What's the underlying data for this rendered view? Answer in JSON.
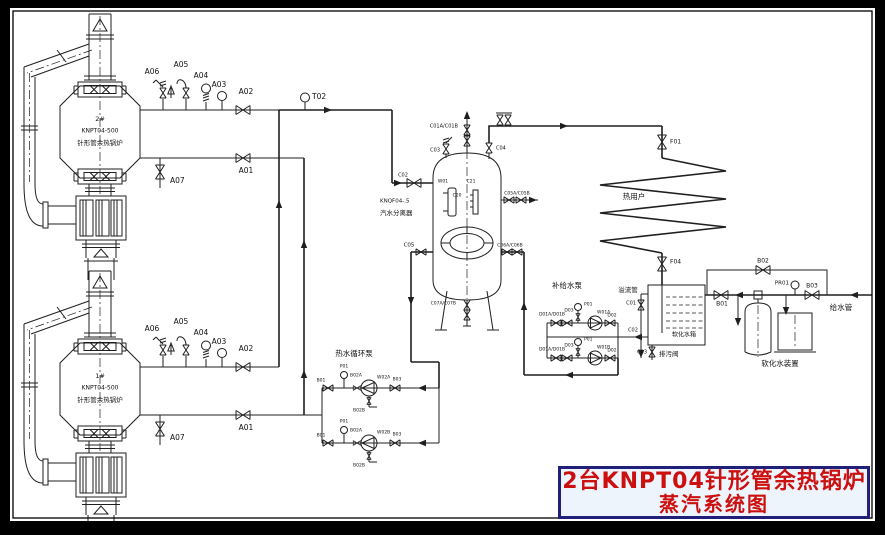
{
  "colors": {
    "line": "#1f1f1f",
    "background": "#ffffff",
    "frame": "#000000",
    "title_text": "#cc0f0f",
    "title_border": "#20207a",
    "title_bg": "#eef4fb"
  },
  "title_block": {
    "line1": "2台KNPT04针形管余热锅炉",
    "line2": "蒸汽系统图"
  },
  "labels": [
    {
      "n": "tag-a06-b1",
      "t": "A06",
      "x": 152,
      "y": 72,
      "s": 7.5
    },
    {
      "n": "tag-a05-b1",
      "t": "A05",
      "x": 181,
      "y": 65,
      "s": 7.5
    },
    {
      "n": "tag-a04-b1",
      "t": "A04",
      "x": 201,
      "y": 76,
      "s": 7.5
    },
    {
      "n": "tag-a03-b1",
      "t": "A03",
      "x": 219,
      "y": 85,
      "s": 7.5
    },
    {
      "n": "tag-a02-b1",
      "t": "A02",
      "x": 246,
      "y": 92,
      "s": 7.5
    },
    {
      "n": "tag-a01-b1",
      "t": "A01",
      "x": 246,
      "y": 171,
      "s": 7.5
    },
    {
      "n": "tag-a07-b1",
      "t": "A07",
      "x": 170,
      "y": 181,
      "s": 7.5,
      "a": "s"
    },
    {
      "n": "boi​ler1-number",
      "t": "2#",
      "x": 100,
      "y": 119,
      "s": 6.5
    },
    {
      "n": "boiler1-model",
      "t": "KNPT04-500",
      "x": 100,
      "y": 131,
      "s": 6
    },
    {
      "n": "boiler1-name",
      "t": "针形管余热锅炉",
      "x": 100,
      "y": 143,
      "s": 6.5
    },
    {
      "n": "tag-a06-b2",
      "t": "A06",
      "x": 152,
      "y": 329,
      "s": 7.5
    },
    {
      "n": "tag-a05-b2",
      "t": "A05",
      "x": 181,
      "y": 322,
      "s": 7.5
    },
    {
      "n": "tag-a04-b2",
      "t": "A04",
      "x": 201,
      "y": 333,
      "s": 7.5
    },
    {
      "n": "tag-a03-b2",
      "t": "A03",
      "x": 219,
      "y": 342,
      "s": 7.5
    },
    {
      "n": "tag-a02-b2",
      "t": "A02",
      "x": 246,
      "y": 349,
      "s": 7.5
    },
    {
      "n": "tag-a01-b2",
      "t": "A01",
      "x": 246,
      "y": 428,
      "s": 7.5
    },
    {
      "n": "tag-a07-b2",
      "t": "A07",
      "x": 170,
      "y": 438,
      "s": 7.5,
      "a": "s"
    },
    {
      "n": "boiler2-number",
      "t": "1#",
      "x": 100,
      "y": 376,
      "s": 6.5
    },
    {
      "n": "boiler2-model",
      "t": "KNPT04-500",
      "x": 100,
      "y": 388,
      "s": 6
    },
    {
      "n": "boiler2-name",
      "t": "针形管余热锅炉",
      "x": 100,
      "y": 400,
      "s": 6.5
    },
    {
      "n": "tag-t02",
      "t": "T02",
      "x": 312,
      "y": 97,
      "s": 7.5,
      "a": "s"
    },
    {
      "n": "tag-c01ab",
      "t": "C01A/C01B",
      "x": 458,
      "y": 126,
      "s": 5,
      "a": "e"
    },
    {
      "n": "tag-c03-vessel",
      "t": "C03",
      "x": 440,
      "y": 150,
      "s": 5,
      "a": "e"
    },
    {
      "n": "tag-c04",
      "t": "C04",
      "x": 496,
      "y": 148,
      "s": 5,
      "a": "s"
    },
    {
      "n": "tag-c02-vessel",
      "t": "C02",
      "x": 403,
      "y": 175,
      "s": 5
    },
    {
      "n": "tag-w01",
      "t": "W01",
      "x": 443,
      "y": 181,
      "s": 4.5
    },
    {
      "n": "tag-c21",
      "t": "C21",
      "x": 471,
      "y": 181,
      "s": 4.5
    },
    {
      "n": "tag-c20",
      "t": "C20",
      "x": 457,
      "y": 195,
      "s": 4.5
    },
    {
      "n": "separator-model",
      "t": "KNQF04-.5",
      "x": 380,
      "y": 201,
      "s": 5.5,
      "a": "s"
    },
    {
      "n": "separator-name",
      "t": "汽水分离器",
      "x": 380,
      "y": 213,
      "s": 6.5,
      "a": "s"
    },
    {
      "n": "tag-c05ab",
      "t": "C05A/C05B",
      "x": 517,
      "y": 193,
      "s": 4.5
    },
    {
      "n": "tag-c05",
      "t": "C05",
      "x": 409,
      "y": 245,
      "s": 5.5
    },
    {
      "n": "tag-c06ab",
      "t": "C06A/C06B",
      "x": 510,
      "y": 245,
      "s": 4.5
    },
    {
      "n": "tag-c07ab",
      "t": "C07A/C07B",
      "x": 456,
      "y": 303,
      "s": 4.5,
      "a": "e"
    },
    {
      "n": "tag-f01",
      "t": "F01",
      "x": 670,
      "y": 142,
      "s": 6,
      "a": "s"
    },
    {
      "n": "heat-user-label",
      "t": "热用户",
      "x": 634,
      "y": 197,
      "s": 7.5
    },
    {
      "n": "tag-f04",
      "t": "F04",
      "x": 670,
      "y": 262,
      "s": 6,
      "a": "s"
    },
    {
      "n": "overflow-pipe-label",
      "t": "溢流管",
      "x": 628,
      "y": 290,
      "s": 6.5
    },
    {
      "n": "tag-c01-tank",
      "t": "C01",
      "x": 636,
      "y": 303,
      "s": 5,
      "a": "e"
    },
    {
      "n": "tag-c02-tank",
      "t": "C02",
      "x": 633,
      "y": 330,
      "s": 5
    },
    {
      "n": "tag-c03-tank",
      "t": "C03",
      "x": 647,
      "y": 352,
      "s": 5,
      "a": "e"
    },
    {
      "n": "blowdown-valve-label",
      "t": "排污阀",
      "x": 659,
      "y": 354,
      "s": 6.5,
      "a": "s"
    },
    {
      "n": "softened-water-tank-label",
      "t": "软化水箱",
      "x": 684,
      "y": 335,
      "s": 6
    },
    {
      "n": "feedwater-pump-label",
      "t": "补给水泵",
      "x": 567,
      "y": 286,
      "s": 7.5
    },
    {
      "n": "tag-d01ab-top",
      "t": "D01A/D01B",
      "x": 552,
      "y": 314,
      "s": 4.5
    },
    {
      "n": "tag-d03-top",
      "t": "D03",
      "x": 569,
      "y": 310,
      "s": 4.5
    },
    {
      "n": "tag-p01-feed-top",
      "t": "P01",
      "x": 584,
      "y": 304,
      "s": 4.5,
      "a": "s"
    },
    {
      "n": "tag-w01a",
      "t": "W01A",
      "x": 597,
      "y": 312,
      "s": 4.5,
      "a": "s"
    },
    {
      "n": "tag-d02-top",
      "t": "D02",
      "x": 612,
      "y": 315,
      "s": 4.5
    },
    {
      "n": "tag-d01ab-bot",
      "t": "D01A/D01B",
      "x": 552,
      "y": 349,
      "s": 4.5
    },
    {
      "n": "tag-d03-bot",
      "t": "D03",
      "x": 569,
      "y": 345,
      "s": 4.5
    },
    {
      "n": "tag-p01-feed-bot",
      "t": "P01",
      "x": 584,
      "y": 339,
      "s": 4.5,
      "a": "s"
    },
    {
      "n": "tag-w01b",
      "t": "W01B",
      "x": 597,
      "y": 347,
      "s": 4.5,
      "a": "s"
    },
    {
      "n": "tag-d02-bot",
      "t": "D02",
      "x": 612,
      "y": 350,
      "s": 4.5
    },
    {
      "n": "circulation-pump-label",
      "t": "热水循环泵",
      "x": 354,
      "y": 354,
      "s": 7.5
    },
    {
      "n": "tag-b01-circ-top",
      "t": "B01",
      "x": 321,
      "y": 380,
      "s": 4.5
    },
    {
      "n": "tag-p01-circ-top",
      "t": "P01",
      "x": 344,
      "y": 366,
      "s": 4.5
    },
    {
      "n": "tag-b02a-top",
      "t": "B02A",
      "x": 356,
      "y": 375,
      "s": 4.5
    },
    {
      "n": "tag-w02a",
      "t": "W02A",
      "x": 377,
      "y": 377,
      "s": 4.5,
      "a": "s"
    },
    {
      "n": "tag-b03-circ-top",
      "t": "B03",
      "x": 397,
      "y": 379,
      "s": 4.5
    },
    {
      "n": "tag-b02b-top",
      "t": "B02B",
      "x": 359,
      "y": 410,
      "s": 4.5
    },
    {
      "n": "tag-b01-circ-bot",
      "t": "B01",
      "x": 321,
      "y": 435,
      "s": 4.5
    },
    {
      "n": "tag-p01-circ-bot",
      "t": "P01",
      "x": 344,
      "y": 421,
      "s": 4.5
    },
    {
      "n": "tag-b02a-bot",
      "t": "B02A",
      "x": 356,
      "y": 430,
      "s": 4.5
    },
    {
      "n": "tag-w02b",
      "t": "W02B",
      "x": 377,
      "y": 432,
      "s": 4.5,
      "a": "s"
    },
    {
      "n": "tag-b03-circ-bot",
      "t": "B03",
      "x": 397,
      "y": 434,
      "s": 4.5
    },
    {
      "n": "tag-b02b-bot",
      "t": "B02B",
      "x": 359,
      "y": 465,
      "s": 4.5
    },
    {
      "n": "feedwater-pipe-label",
      "t": "给水管",
      "x": 841,
      "y": 308,
      "s": 7.5
    },
    {
      "n": "tag-b03-fw",
      "t": "B03",
      "x": 812,
      "y": 286,
      "s": 6
    },
    {
      "n": "tag-pr01",
      "t": "PR01",
      "x": 789,
      "y": 283,
      "s": 5.5,
      "a": "e"
    },
    {
      "n": "tag-b02-fw",
      "t": "B02",
      "x": 763,
      "y": 261,
      "s": 6
    },
    {
      "n": "tag-b01-fw",
      "t": "B01",
      "x": 722,
      "y": 304,
      "s": 6
    },
    {
      "n": "softener-unit-label",
      "t": "软化水装置",
      "x": 780,
      "y": 364,
      "s": 7.5
    }
  ]
}
